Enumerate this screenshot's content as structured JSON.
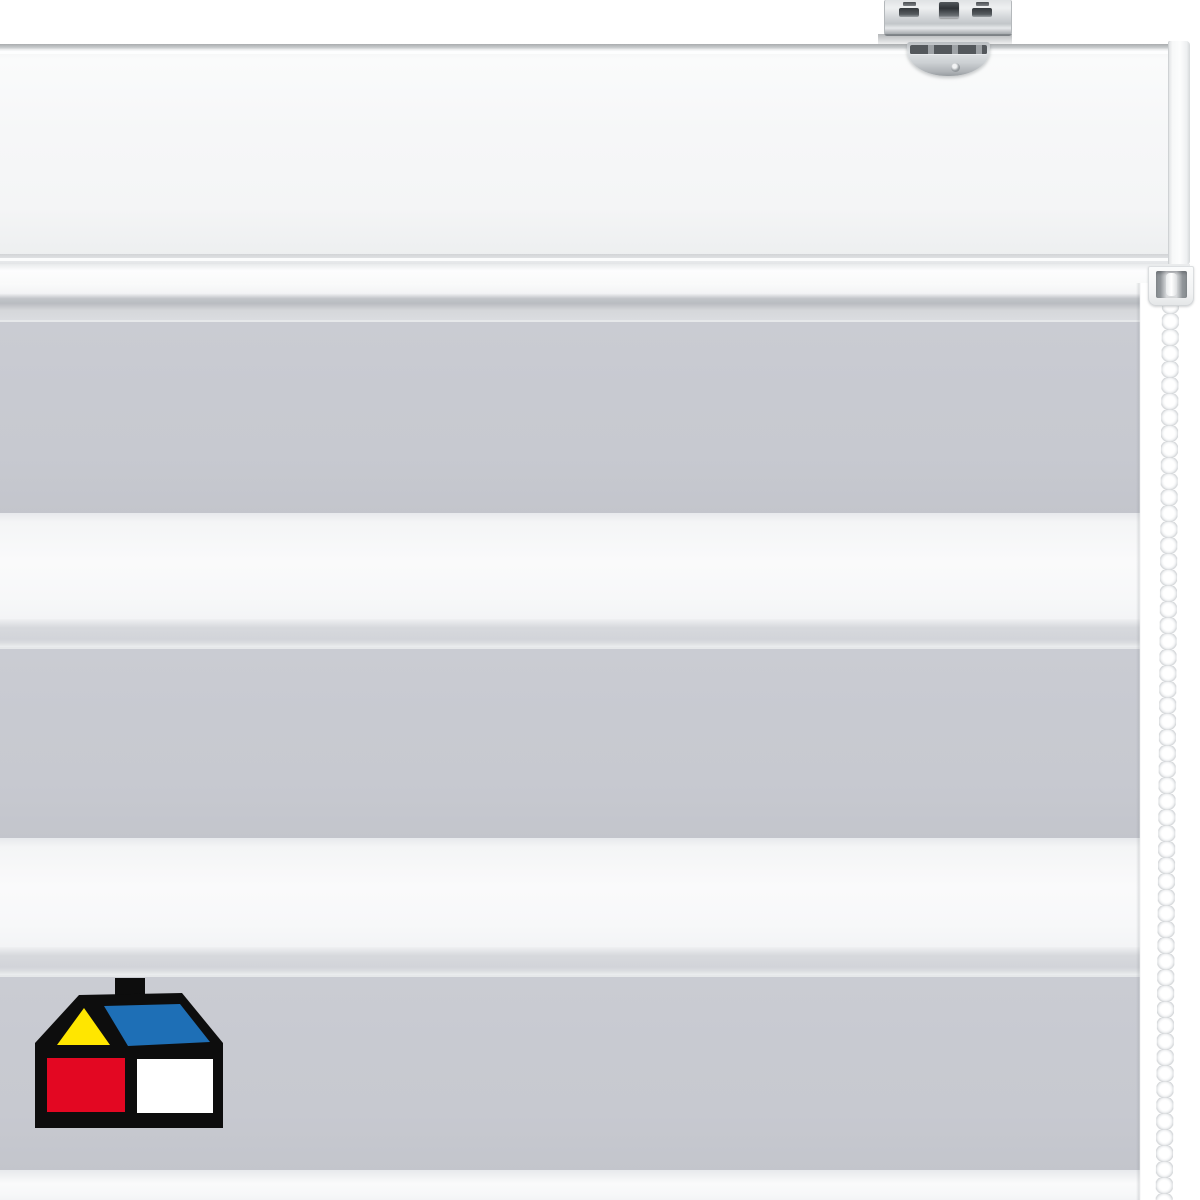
{
  "meta": {
    "kind": "product-photo",
    "description": "White day/night zebra roller blind: ceiling-mount metal bracket, white cassette headrail, striped gray/white fabric, white bead chain on the right, house logo at bottom left"
  },
  "palette": {
    "background": "#ffffff",
    "fabric_gray": "#c7c9d0",
    "fabric_sheer": "#d3d6da",
    "fabric_white": "#f5f6f7",
    "rail_white": "#f6f7f8",
    "metal_light": "#eef0f1",
    "metal_mid": "#c2c6c9",
    "metal_dark": "#8d9195"
  },
  "blind": {
    "fabric_right_edge_x": 1140,
    "stripes": [
      {
        "kind": "roll",
        "y": 283,
        "h": 37
      },
      {
        "kind": "gray",
        "y": 320,
        "h": 193
      },
      {
        "kind": "white",
        "y": 513,
        "h": 106
      },
      {
        "kind": "sheer",
        "y": 619,
        "h": 28
      },
      {
        "kind": "gray",
        "y": 647,
        "h": 191
      },
      {
        "kind": "white",
        "y": 838,
        "h": 109
      },
      {
        "kind": "sheer",
        "y": 947,
        "h": 28
      },
      {
        "kind": "gray",
        "y": 975,
        "h": 195
      },
      {
        "kind": "white",
        "y": 1170,
        "h": 30
      }
    ],
    "chain": {
      "bead_color": "#ffffff",
      "bead_diameter_px": 17,
      "bead_spacing_px": 16,
      "tilt_deg": 0.4
    }
  },
  "logo": {
    "name": "house-logo",
    "colors": {
      "outline": "#0d0d0d",
      "gable": "#ffe600",
      "roof": "#1e6fb6",
      "block_left": "#e30722",
      "block_right": "#ffffff"
    }
  }
}
